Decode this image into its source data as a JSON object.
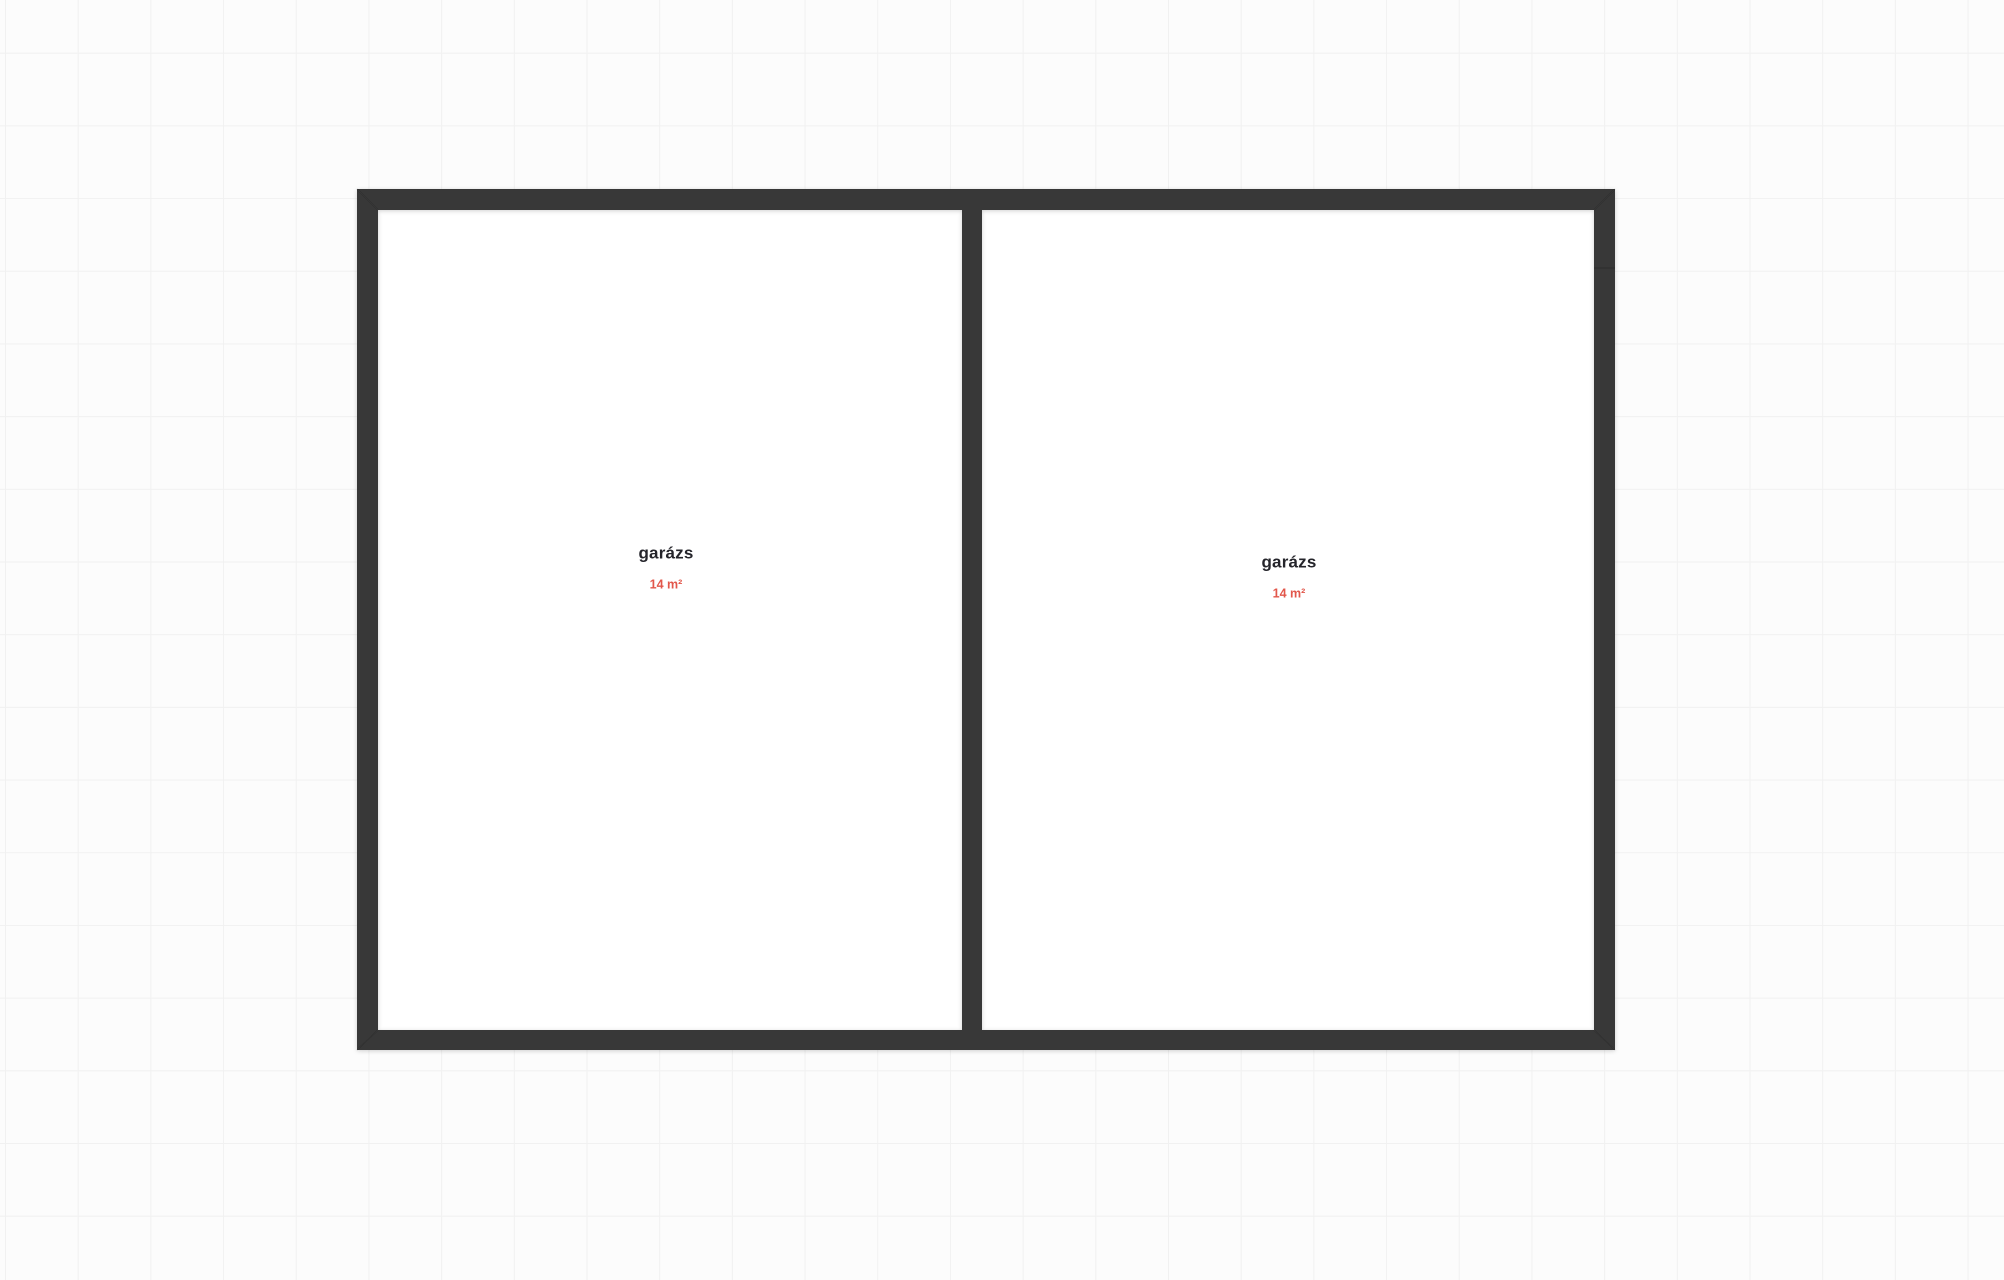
{
  "colors": {
    "canvas_bg": "#fcfcfc",
    "grid_line": "#f1f1f1",
    "wall": "#383838",
    "room_fill": "#ffffff",
    "room_name": "#25252b",
    "room_area": "#e2574b"
  },
  "plan": {
    "rooms": [
      {
        "name": "garázs",
        "area": "14 m²"
      },
      {
        "name": "garázs",
        "area": "14 m²"
      }
    ]
  }
}
